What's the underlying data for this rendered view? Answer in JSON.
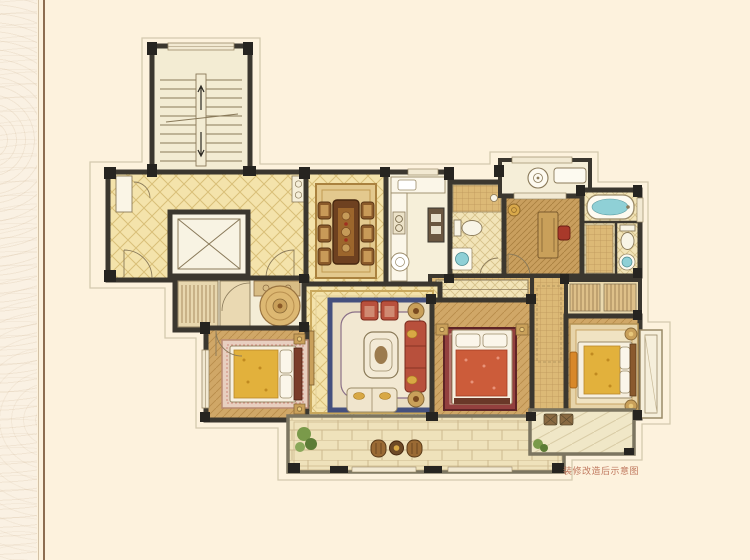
{
  "caption": {
    "text": "装修改造后示意图",
    "color": "#c0785e"
  },
  "palette": {
    "background": "#fdf2dd",
    "margin_background": "#faf1e3",
    "margin_line_dark": "#8d6d50",
    "wall": "#3b372f",
    "column": "#262420",
    "tile_floor": "#f4e3ab",
    "tile_line": "#d9bf78",
    "wood_floor": "#d0a767",
    "pale_floor": "#f4edd6",
    "rug_border_blue": "#44507e",
    "sofa_red": "#b8503c",
    "bed_gold": "#e2b13c",
    "bed_red": "#cc5c3a",
    "rug_dark_red": "#93403e",
    "water_teal": "#8fd0d6",
    "plant_green": "#7a9a4a",
    "balcony_paving": "#efe2bb",
    "offset_outline": "#d4c9ae"
  }
}
